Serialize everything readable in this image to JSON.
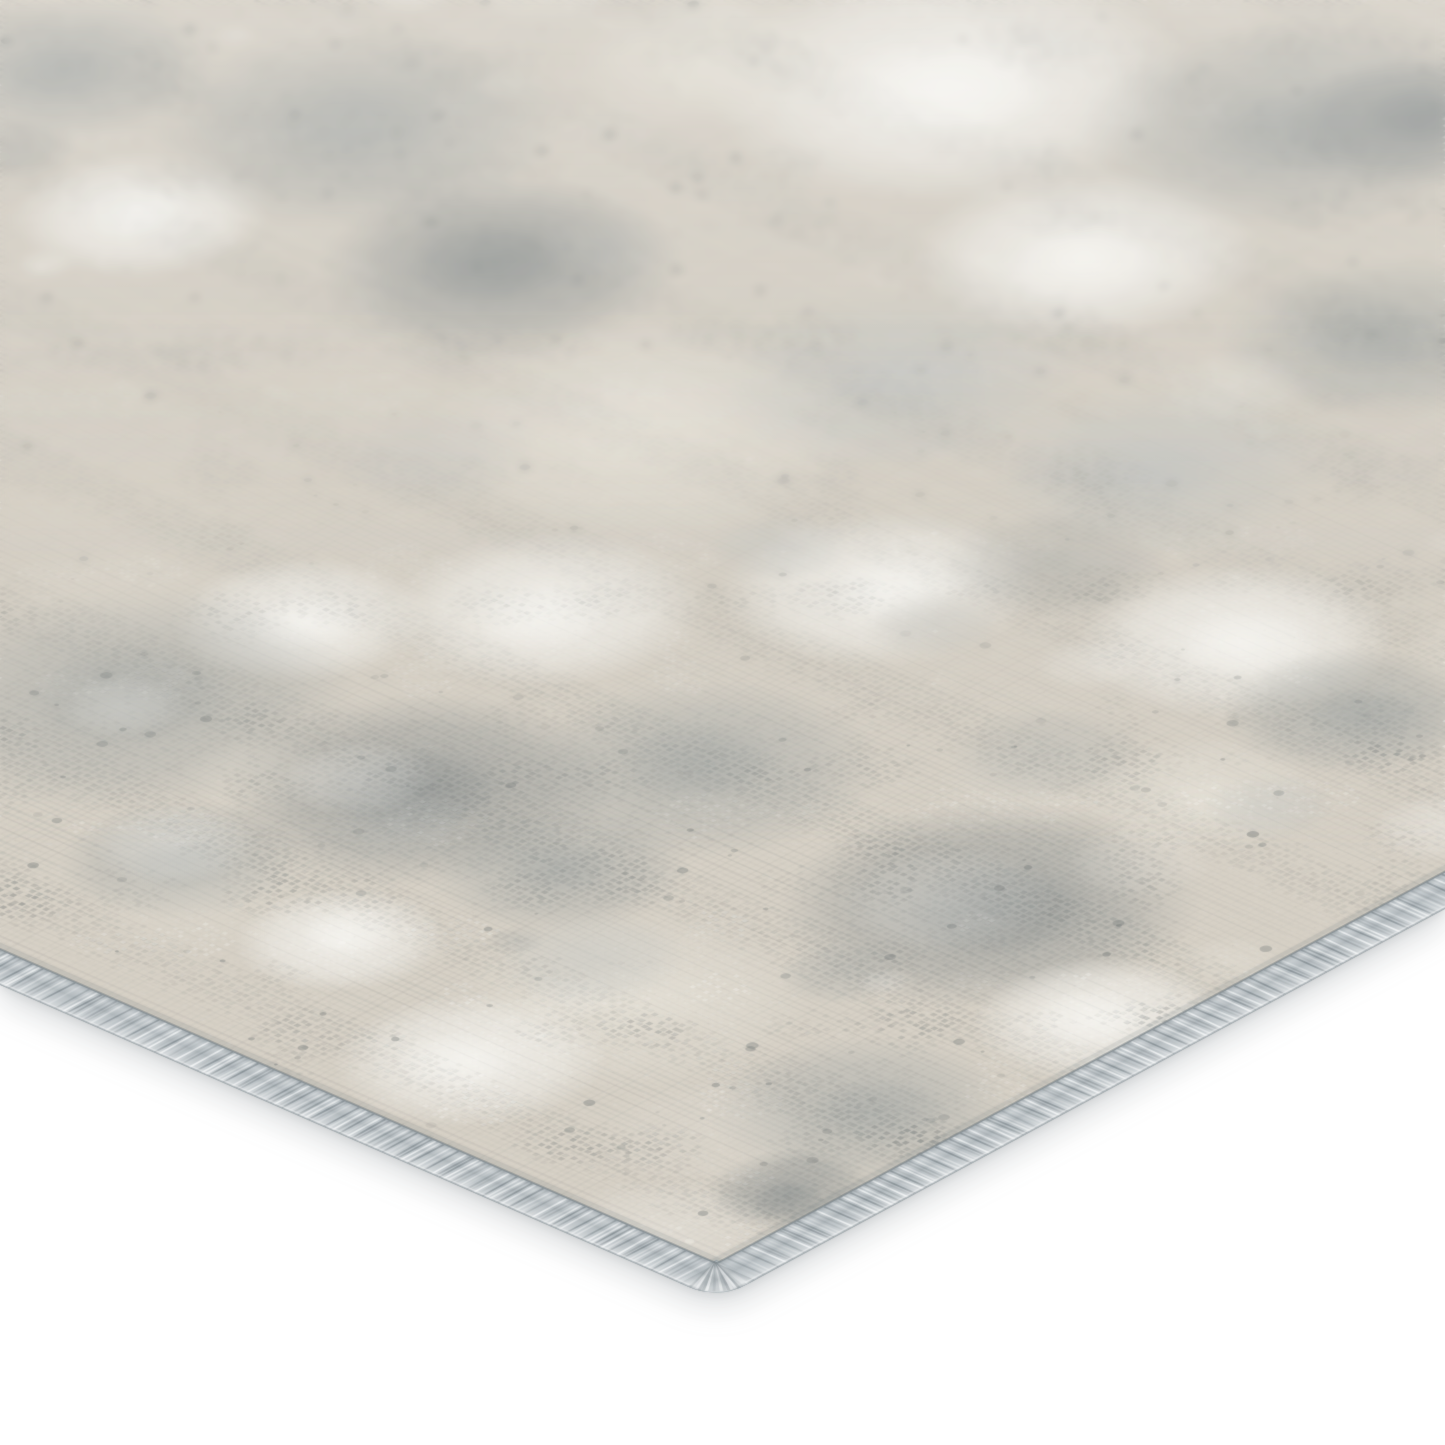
{
  "image": {
    "description": "Corner close-up product photo of an abstract distressed area rug in gray, ivory and beige tones on a plain white background, photographed at an oblique angle with the far side out of focus",
    "width_px": 1445,
    "height_px": 1445,
    "background_color": "#ffffff"
  },
  "rug": {
    "corner_px": {
      "x": 718,
      "y": 1300
    },
    "left_edge_exit_px": {
      "x": 0,
      "y": 985
    },
    "right_edge_exit_px": {
      "x": 1445,
      "y": 909
    },
    "binding": {
      "width_px": 42,
      "corner_radius_px": 34,
      "base_color": "#bdc4c8",
      "highlight_color": "#eaedee",
      "shadow_color": "#8d969b",
      "groove_color": "#5f6a70"
    },
    "pile": {
      "base_color": "#d7d1c6",
      "palette": {
        "beige_dark": "#c8c1b2",
        "beige": "#d6d0c5",
        "cream": "#e7e3d9",
        "white": "#f8f7f3",
        "gray_light": "#bfc2c0",
        "gray": "#a4a8a6",
        "gray_dark": "#8d9292",
        "fleck_dark": "#6e7474"
      }
    },
    "texture": {
      "seed": 424242,
      "weave_step_px": 7,
      "dot_size_px": 4.6,
      "mid_blob_count": 130,
      "dark_fleck_count": 900,
      "white_fleck_count": 600,
      "fuzz_count": 9000
    },
    "macro_patches": [
      {
        "x": 950,
        "y": 85,
        "r": 160,
        "tone": "white"
      },
      {
        "x": 1085,
        "y": 255,
        "r": 115,
        "tone": "white"
      },
      {
        "x": 715,
        "y": 60,
        "r": 95,
        "tone": "cream"
      },
      {
        "x": 140,
        "y": 215,
        "r": 85,
        "tone": "white"
      },
      {
        "x": 70,
        "y": 70,
        "r": 95,
        "tone": "gray"
      },
      {
        "x": 355,
        "y": 130,
        "r": 135,
        "tone": "gray"
      },
      {
        "x": 500,
        "y": 265,
        "r": 120,
        "tone": "gray_dark"
      },
      {
        "x": 1290,
        "y": 125,
        "r": 140,
        "tone": "gray"
      },
      {
        "x": 1420,
        "y": 120,
        "r": 90,
        "tone": "gray_dark"
      },
      {
        "x": 1385,
        "y": 340,
        "r": 110,
        "tone": "gray"
      },
      {
        "x": 240,
        "y": 420,
        "r": 140,
        "tone": "beige"
      },
      {
        "x": 650,
        "y": 430,
        "r": 150,
        "tone": "cream"
      },
      {
        "x": 545,
        "y": 610,
        "r": 105,
        "tone": "white"
      },
      {
        "x": 880,
        "y": 590,
        "r": 105,
        "tone": "white"
      },
      {
        "x": 1235,
        "y": 640,
        "r": 105,
        "tone": "white"
      },
      {
        "x": 300,
        "y": 620,
        "r": 85,
        "tone": "white"
      },
      {
        "x": 130,
        "y": 700,
        "r": 150,
        "tone": "gray"
      },
      {
        "x": 420,
        "y": 790,
        "r": 130,
        "tone": "gray_dark"
      },
      {
        "x": 700,
        "y": 770,
        "r": 120,
        "tone": "gray"
      },
      {
        "x": 560,
        "y": 870,
        "r": 85,
        "tone": "gray"
      },
      {
        "x": 990,
        "y": 905,
        "r": 140,
        "tone": "gray_dark"
      },
      {
        "x": 1245,
        "y": 855,
        "r": 110,
        "tone": "beige"
      },
      {
        "x": 1200,
        "y": 795,
        "r": 80,
        "tone": "cream"
      },
      {
        "x": 210,
        "y": 950,
        "r": 115,
        "tone": "beige"
      },
      {
        "x": 180,
        "y": 860,
        "r": 80,
        "tone": "gray"
      },
      {
        "x": 340,
        "y": 940,
        "r": 70,
        "tone": "white"
      },
      {
        "x": 630,
        "y": 1000,
        "r": 120,
        "tone": "cream"
      },
      {
        "x": 860,
        "y": 1110,
        "r": 100,
        "tone": "gray"
      },
      {
        "x": 790,
        "y": 1190,
        "r": 55,
        "tone": "gray_dark"
      },
      {
        "x": 470,
        "y": 1060,
        "r": 90,
        "tone": "white"
      },
      {
        "x": 1100,
        "y": 1020,
        "r": 85,
        "tone": "white"
      },
      {
        "x": 1350,
        "y": 710,
        "r": 85,
        "tone": "gray"
      },
      {
        "x": 1300,
        "y": 940,
        "r": 70,
        "tone": "beige"
      },
      {
        "x": 50,
        "y": 510,
        "r": 95,
        "tone": "beige"
      },
      {
        "x": 900,
        "y": 380,
        "r": 120,
        "tone": "gray_light"
      },
      {
        "x": 1160,
        "y": 470,
        "r": 110,
        "tone": "gray_light"
      }
    ],
    "shadow": {
      "outer_color": "rgba(110,118,124,0.22)",
      "inner_color": "rgba(110,118,124,0.18)"
    },
    "depth_blur": {
      "max_blur_px": 4.5,
      "full_blur_until_pct": 21,
      "sharp_from_pct": 59
    }
  }
}
